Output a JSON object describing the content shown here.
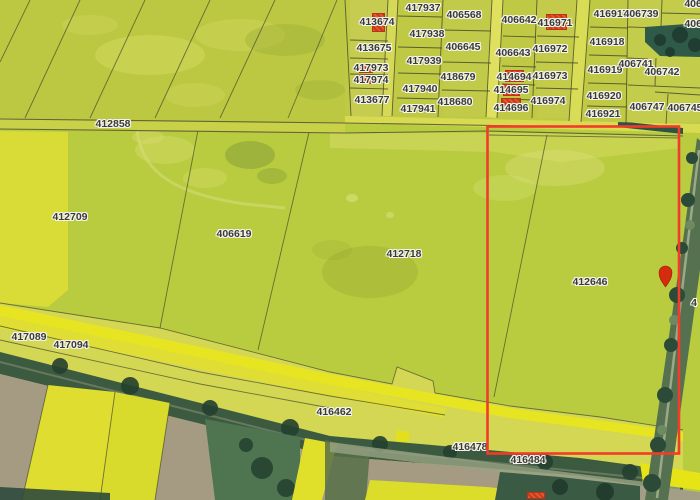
{
  "map": {
    "kind": "cadastral-parcel-aerial-map",
    "selected_parcel": "412646",
    "colors": {
      "selection_outline": "#f23b2a",
      "marker": "#d42c0c",
      "building": "#e05a30",
      "building_outline": "#c03018",
      "label_text": "#3a3a3a",
      "label_halo": "#f4f4ea",
      "field_green": "#b9cc3f",
      "field_bright_yellow": "#dcdc2e",
      "road_yellow": "#e6e41c",
      "hedge_green": "#3c5a40",
      "soil_grey": "#a49b82",
      "trees_teal": "#2f5a48"
    },
    "selection_rect": {
      "x": 487.5,
      "y": 126.5,
      "width": 191.5,
      "height": 327
    },
    "marker": {
      "x": 665.5,
      "y": 273,
      "tip_y": 287
    },
    "parcel_labels": [
      {
        "text": "412858",
        "x": 113,
        "y": 124
      },
      {
        "text": "412709",
        "x": 70,
        "y": 217
      },
      {
        "text": "406619",
        "x": 234,
        "y": 234
      },
      {
        "text": "412718",
        "x": 404,
        "y": 254
      },
      {
        "text": "412646",
        "x": 590,
        "y": 282
      },
      {
        "text": "417089",
        "x": 29,
        "y": 337
      },
      {
        "text": "417094",
        "x": 71,
        "y": 345
      },
      {
        "text": "416462",
        "x": 334,
        "y": 412
      },
      {
        "text": "416478",
        "x": 470,
        "y": 447
      },
      {
        "text": "416484",
        "x": 528,
        "y": 460
      },
      {
        "text": "413674",
        "x": 377,
        "y": 22,
        "building": true
      },
      {
        "text": "413675",
        "x": 374,
        "y": 48
      },
      {
        "text": "417973",
        "x": 371,
        "y": 68,
        "building": true
      },
      {
        "text": "417974",
        "x": 371,
        "y": 80,
        "building": true
      },
      {
        "text": "413677",
        "x": 372,
        "y": 100
      },
      {
        "text": "417937",
        "x": 423,
        "y": 8
      },
      {
        "text": "417938",
        "x": 427,
        "y": 34
      },
      {
        "text": "417939",
        "x": 424,
        "y": 61
      },
      {
        "text": "417940",
        "x": 420,
        "y": 89
      },
      {
        "text": "417941",
        "x": 418,
        "y": 109
      },
      {
        "text": "406568",
        "x": 464,
        "y": 15
      },
      {
        "text": "406645",
        "x": 463,
        "y": 47
      },
      {
        "text": "418679",
        "x": 458,
        "y": 77
      },
      {
        "text": "418680",
        "x": 455,
        "y": 102
      },
      {
        "text": "406642",
        "x": 519,
        "y": 20
      },
      {
        "text": "406643",
        "x": 513,
        "y": 53
      },
      {
        "text": "414694",
        "x": 514,
        "y": 77,
        "building": true
      },
      {
        "text": "414695",
        "x": 511,
        "y": 90,
        "building": true
      },
      {
        "text": "414696",
        "x": 511,
        "y": 108,
        "building": true
      },
      {
        "text": "416971",
        "x": 555,
        "y": 23,
        "building": true
      },
      {
        "text": "416972",
        "x": 550,
        "y": 49
      },
      {
        "text": "416973",
        "x": 550,
        "y": 76
      },
      {
        "text": "416974",
        "x": 548,
        "y": 101
      },
      {
        "text": "416917",
        "x": 611,
        "y": 14
      },
      {
        "text": "406739",
        "x": 641,
        "y": 14
      },
      {
        "text": "416918",
        "x": 607,
        "y": 42
      },
      {
        "text": "416919",
        "x": 605,
        "y": 70
      },
      {
        "text": "406741",
        "x": 636,
        "y": 64
      },
      {
        "text": "406742",
        "x": 662,
        "y": 72
      },
      {
        "text": "416920",
        "x": 604,
        "y": 96
      },
      {
        "text": "416921",
        "x": 603,
        "y": 114
      },
      {
        "text": "406747",
        "x": 647,
        "y": 107
      },
      {
        "text": "406745",
        "x": 685,
        "y": 108
      },
      {
        "text": "4067",
        "x": 696,
        "y": 4,
        "clipped": true
      },
      {
        "text": "40673",
        "x": 699,
        "y": 24,
        "clipped": true
      },
      {
        "text": "4",
        "x": 694,
        "y": 303,
        "clipped": true
      }
    ],
    "buildings": [
      {
        "x": 372,
        "y": 13,
        "w": 13,
        "h": 19
      },
      {
        "x": 546,
        "y": 14,
        "w": 21,
        "h": 16
      },
      {
        "x": 359,
        "y": 64,
        "w": 14,
        "h": 9
      },
      {
        "x": 358,
        "y": 75,
        "w": 13,
        "h": 9
      },
      {
        "x": 505,
        "y": 70,
        "w": 19,
        "h": 12
      },
      {
        "x": 503,
        "y": 84,
        "w": 17,
        "h": 12
      },
      {
        "x": 501,
        "y": 98,
        "w": 20,
        "h": 13
      },
      {
        "x": 527,
        "y": 492,
        "w": 18,
        "h": 7
      }
    ]
  }
}
